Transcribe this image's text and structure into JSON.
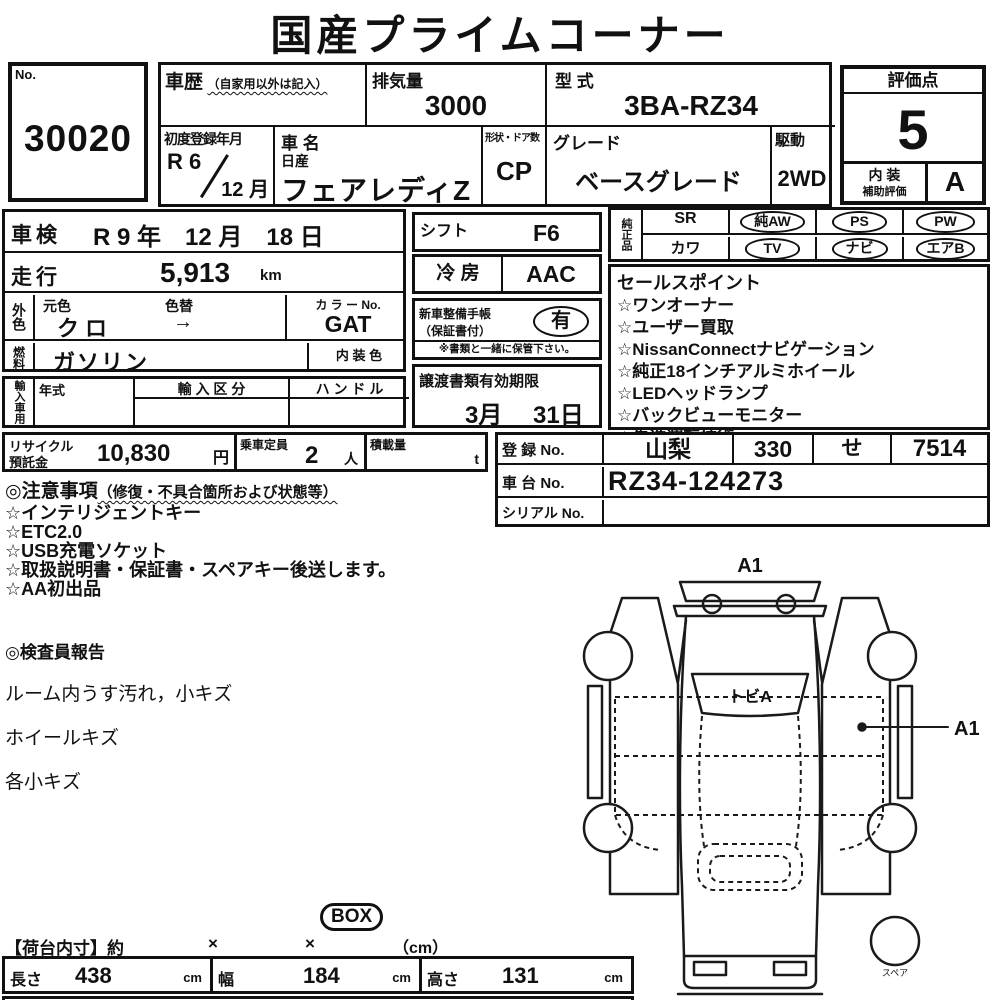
{
  "title": "国産プライムコーナー",
  "lot": {
    "label": "No.",
    "value": "30020"
  },
  "top": {
    "history_label": "車歴",
    "history_note": "（自家用以外は記入）",
    "disp_label": "排気量",
    "disp_value": "3000",
    "model_label": "型 式",
    "model_value": "3BA-RZ34",
    "reg_label": "初度登録年月",
    "reg_era": "R 6",
    "reg_month": "12 月",
    "name_label": "車 名",
    "maker": "日産",
    "car_name": "フェアレディZ",
    "shape_label": "形状・ドア数",
    "shape_value": "CP",
    "grade_label": "グレード",
    "grade_value": "ベースグレード",
    "drive_label": "駆動",
    "drive_value": "2WD"
  },
  "rating": {
    "label": "評価点",
    "score": "5",
    "interior_label": "内 装",
    "interior_sub": "補助評価",
    "interior_score": "A"
  },
  "left": {
    "shaken_label": "車検",
    "shaken_value": "R 9 年　12 月　18 日",
    "mileage_label": "走行",
    "mileage_value": "5,913",
    "mileage_unit": "km",
    "ext_label": "外色",
    "base_label": "元色",
    "change_label": "色替",
    "base_value": "クロ",
    "change_value": "→",
    "colorno_label": "カ ラ ー No.",
    "colorno_value": "GAT",
    "fuel_label": "燃料",
    "fuel_value": "ガソリン",
    "intcolor_label": "内 装 色",
    "import_label": "輸入車用",
    "year_label": "年式",
    "class_label": "輸 入 区 分",
    "handle_label": "ハ ン ド ル"
  },
  "mid": {
    "shift_label": "シフト",
    "shift_value": "F6",
    "ac_label": "冷 房",
    "ac_value": "AAC",
    "book_label1": "新車整備手帳",
    "book_label2": "（保証書付）",
    "book_value": "有",
    "book_note": "※書類と一緒に保管下さい。",
    "transfer_label": "譲渡書類有効期限",
    "transfer_month": "3月",
    "transfer_day": "31日"
  },
  "oem": {
    "label": "純正品",
    "row1": [
      {
        "label": "SR",
        "circled": false
      },
      {
        "label": "純AW",
        "circled": true
      },
      {
        "label": "PS",
        "circled": true
      },
      {
        "label": "PW",
        "circled": true
      }
    ],
    "row2": [
      {
        "label": "カワ",
        "circled": false
      },
      {
        "label": "TV",
        "circled": true
      },
      {
        "label": "ナビ",
        "circled": true
      },
      {
        "label": "エアB",
        "circled": true
      }
    ]
  },
  "sales": {
    "title": "セールスポイント",
    "items": [
      "☆ワンオーナー",
      "☆ユーザー買取",
      "☆NissanConnectナビゲーション",
      "☆純正18インチアルミホイール",
      "☆LEDヘッドランプ",
      "☆バックビューモニター",
      "☆先進運転技術"
    ]
  },
  "bottom": {
    "recycle_label1": "リサイクル",
    "recycle_label2": "預託金",
    "recycle_value": "10,830",
    "recycle_unit": "円",
    "capacity_label": "乗車定員",
    "capacity_value": "2",
    "capacity_unit": "人",
    "load_label": "積載量",
    "load_unit": "t"
  },
  "registration": {
    "reg_label": "登 録 No.",
    "area": "山梨",
    "class_no": "330",
    "kana": "せ",
    "number": "7514",
    "chassis_label": "車 台 No.",
    "chassis_value": "RZ34-124273",
    "serial_label": "シリアル No.",
    "serial_value": ""
  },
  "notes": {
    "title_main": "◎注意事項",
    "title_sub": "（修復・不具合箇所および状態等）",
    "items": [
      "☆インテリジェントキー",
      "☆ETC2.0",
      "☆USB充電ソケット",
      "☆取扱説明書・保証書・スペアキー後送します。",
      "☆AA初出品"
    ]
  },
  "inspector": {
    "title": "◎検査員報告",
    "items": [
      "ルーム内うす汚れ，小キズ",
      "ホイールキズ",
      "各小キズ"
    ]
  },
  "diagram": {
    "top_label": "A1",
    "windshield_label": "トビA",
    "pointer_label": "A1",
    "spare_label": "スペア"
  },
  "cargo": {
    "box_badge": "BOX",
    "title": "【荷台内寸】約",
    "times1": "×",
    "times2": "×",
    "unit_note": "（cm）",
    "length_label": "長さ",
    "length_value": "438",
    "length_unit": "cm",
    "width_label": "幅",
    "width_value": "184",
    "width_unit": "cm",
    "height_label": "高さ",
    "height_value": "131",
    "height_unit": "cm"
  },
  "colors": {
    "ink": "#111111",
    "paper": "#ffffff"
  }
}
